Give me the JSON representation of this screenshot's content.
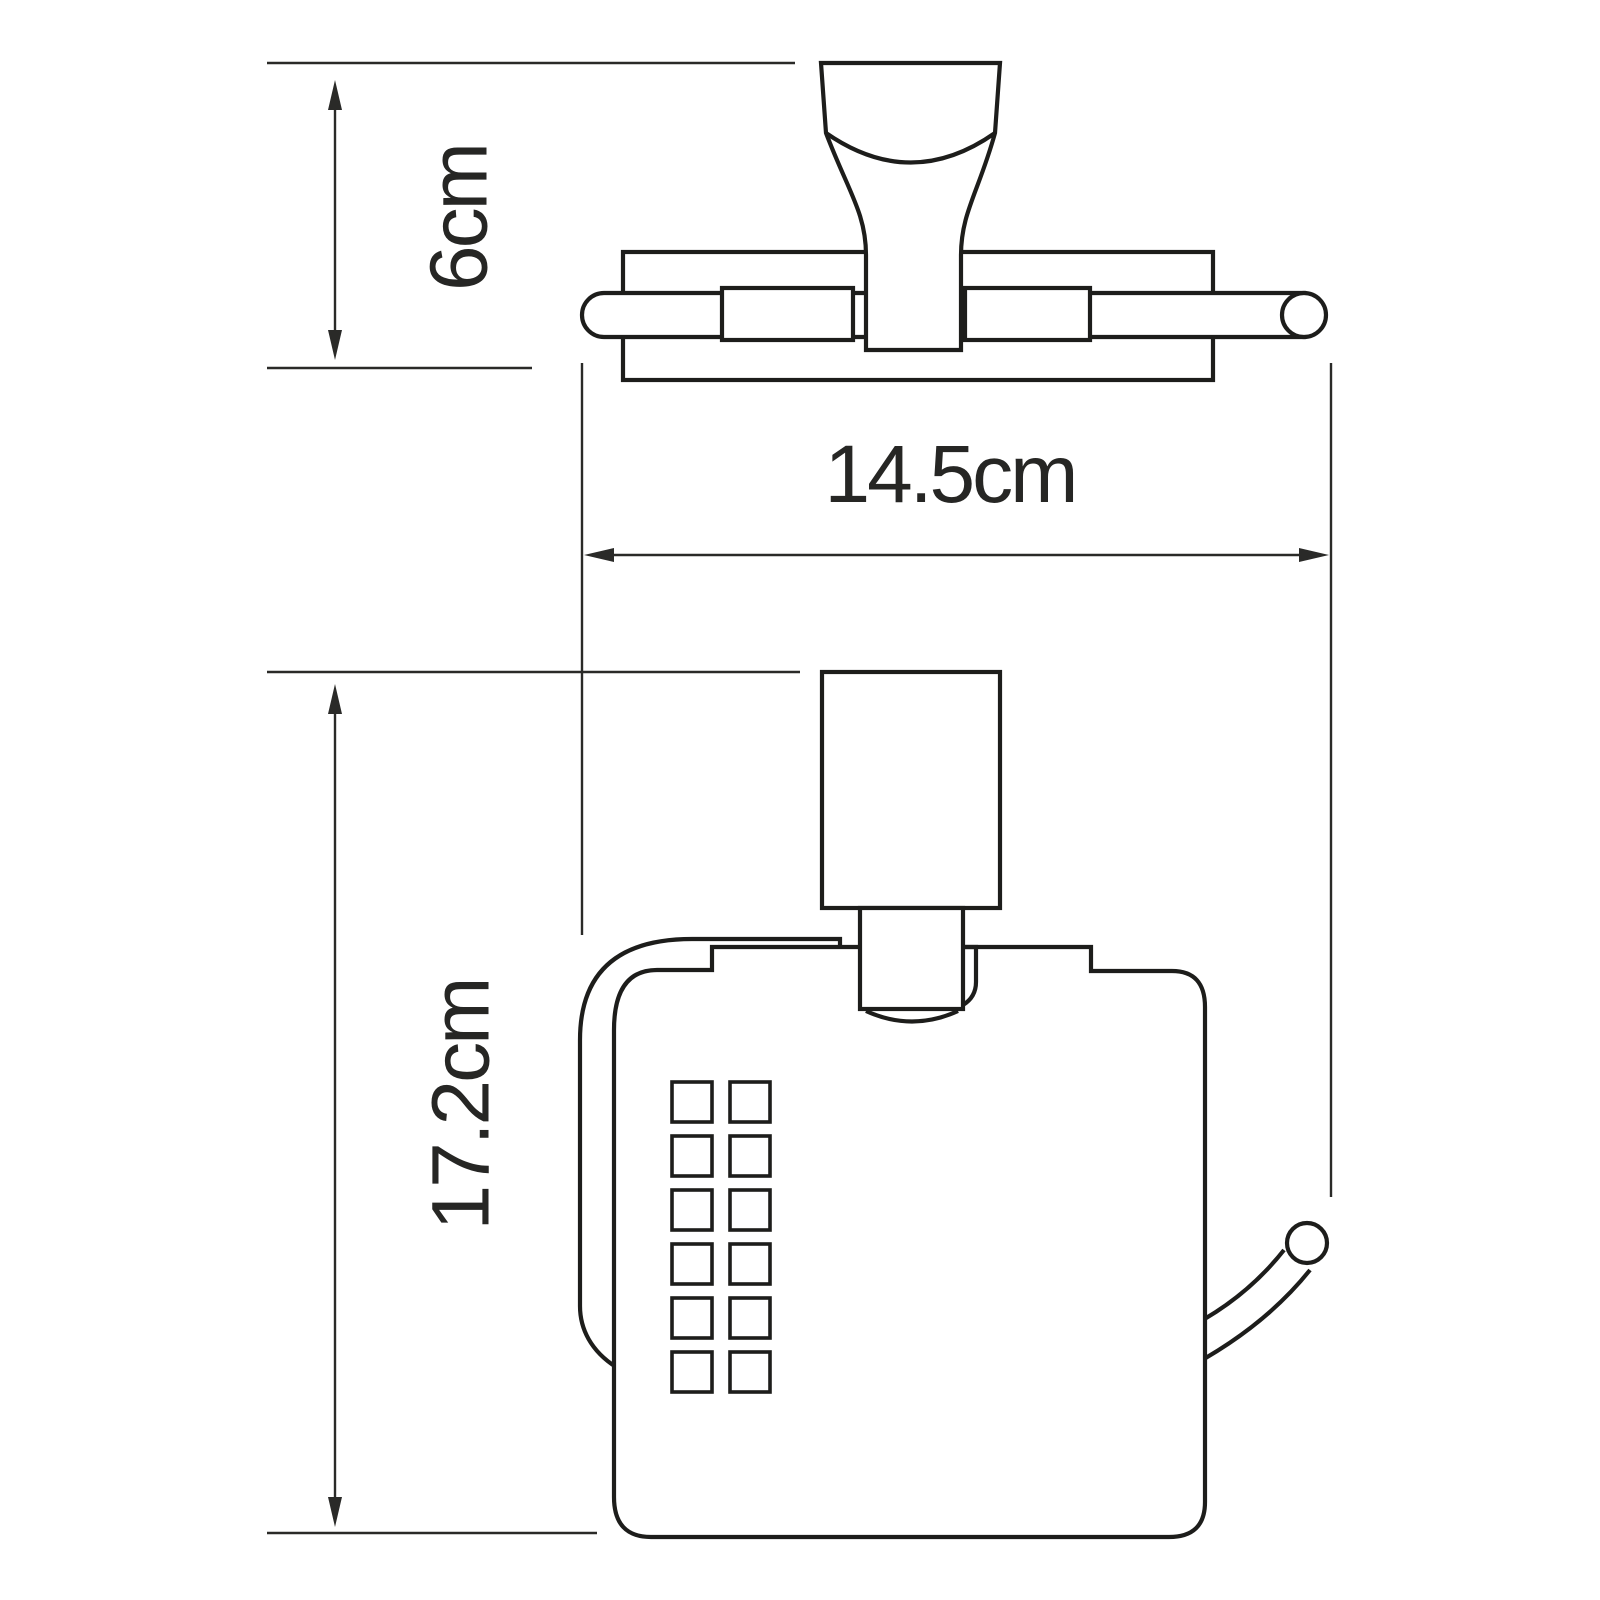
{
  "diagram": {
    "description": "Technical dimension drawing of a wall-mounted toilet paper holder with cover, shown in top view and front view",
    "background_color": "#ffffff",
    "line_color": "#1d1d1b",
    "dimension_color": "#2a2a28",
    "views": [
      {
        "id": "top-view",
        "name": "bracket and roller bar seen from above"
      },
      {
        "id": "front-view",
        "name": "covered paper holder seen from the front"
      }
    ],
    "dimensions": [
      {
        "label": "6cm",
        "orientation": "vertical",
        "measures": "bracket depth in top view"
      },
      {
        "label": "14.5cm",
        "orientation": "horizontal",
        "measures": "overall width"
      },
      {
        "label": "17.2cm",
        "orientation": "vertical",
        "measures": "overall height in front view"
      }
    ],
    "front_view": {
      "vent_grid": {
        "columns": 2,
        "rows": 6,
        "x": 672,
        "y": 1082,
        "cell": 40,
        "pitch_x": 58,
        "pitch_y": 54
      }
    }
  }
}
